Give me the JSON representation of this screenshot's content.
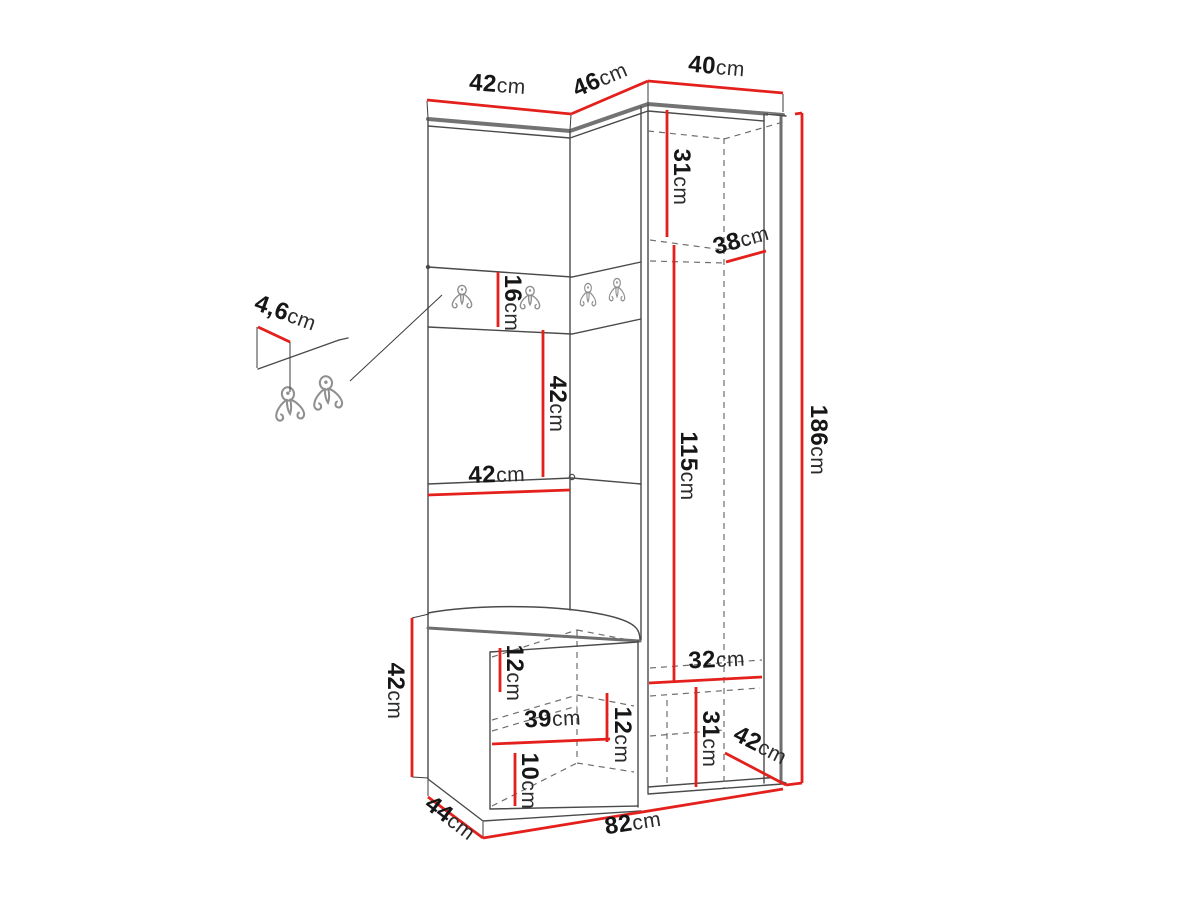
{
  "figure": {
    "type": "furniture-dimension-diagram",
    "subject": "hallway corner wardrobe with coat hooks, open-door cabinet and bench",
    "background_color": "#ffffff",
    "outline_color": "#4a4a4a",
    "dimension_line_color": "#e4201c",
    "hidden_line_style": "dashed"
  },
  "unit": "cm",
  "dims": {
    "top_left_width": "42",
    "top_mid_width": "46",
    "top_right_width": "40",
    "upper_shelf_height": "31",
    "shelf_depth": "38",
    "hook_panel_height": "16",
    "mid_back_height": "42",
    "left_panel_width": "42",
    "tall_inner_height": "115",
    "total_height": "186",
    "bottom_inner_width": "32",
    "bottom_compartment_height": "31",
    "bottom_depth": "42",
    "seat_thickness": "12",
    "bench_inner_width": "39",
    "bench_shelf_spacing": "12",
    "bench_bottom_spacing": "10",
    "bench_height": "42",
    "bench_depth": "44",
    "total_width": "82",
    "hook_panel_thickness": "4,6"
  },
  "icons": {
    "coat_hook_count_main": 4,
    "coat_hook_count_detail": 2
  }
}
